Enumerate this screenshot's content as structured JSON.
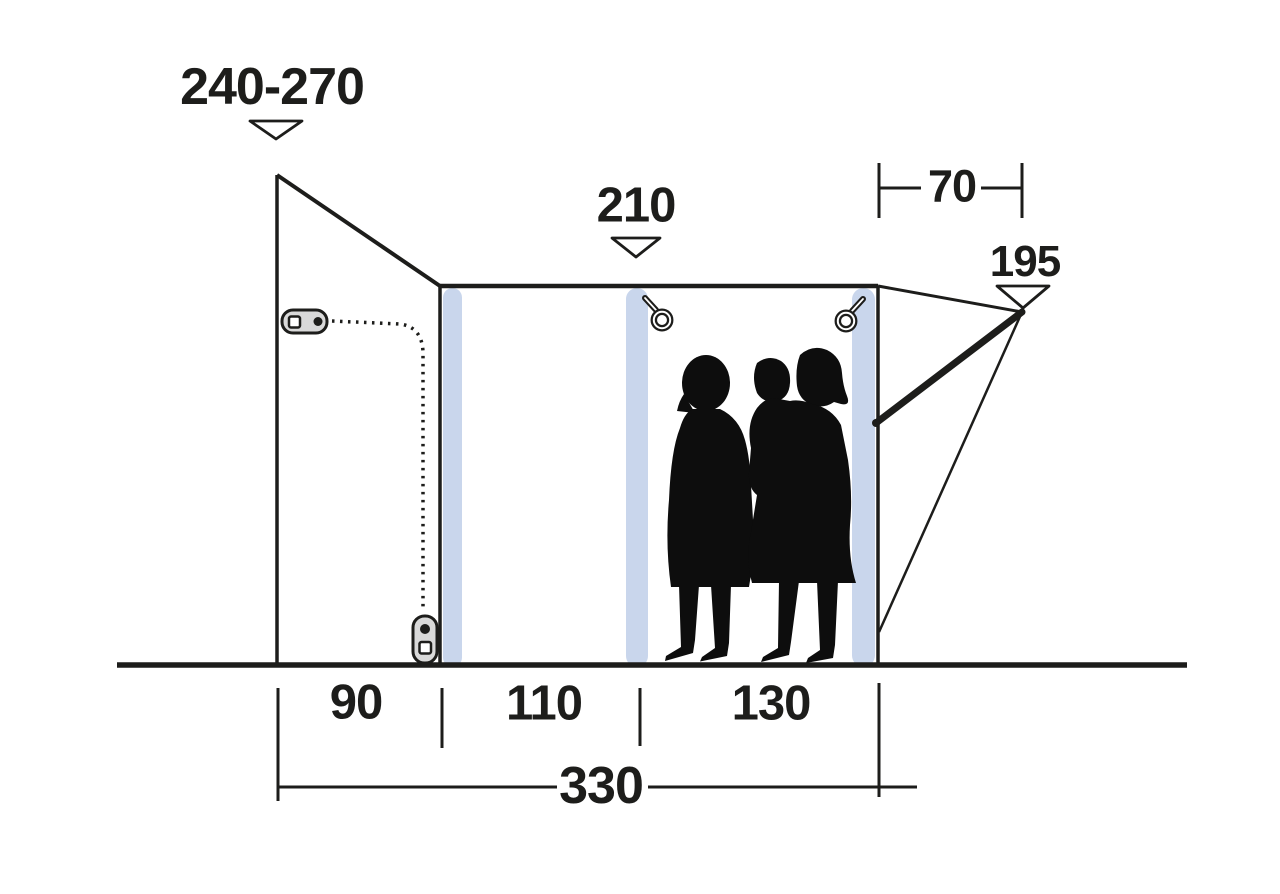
{
  "diagram": {
    "title": "tent-side-profile-dimension-diagram",
    "labels": {
      "height_left": "240-270",
      "height_mid": "210",
      "depth_top": "70",
      "height_right": "195",
      "width_rear": "90",
      "width_mid": "110",
      "width_front": "130",
      "width_total": "330"
    },
    "colors": {
      "line": "#1d1d1b",
      "beam_blue": "#c9d6ec",
      "pull_gray": "#d9d9d9",
      "silhouette": "#0d0d0d",
      "background": "#ffffff"
    },
    "icons": {
      "marker": "triangle-down-marker",
      "zipper_top": "zipper-pull-icon",
      "zipper_bottom": "zipper-pull-icon",
      "ring_left": "ring-pull-icon",
      "ring_right": "ring-pull-icon"
    }
  }
}
